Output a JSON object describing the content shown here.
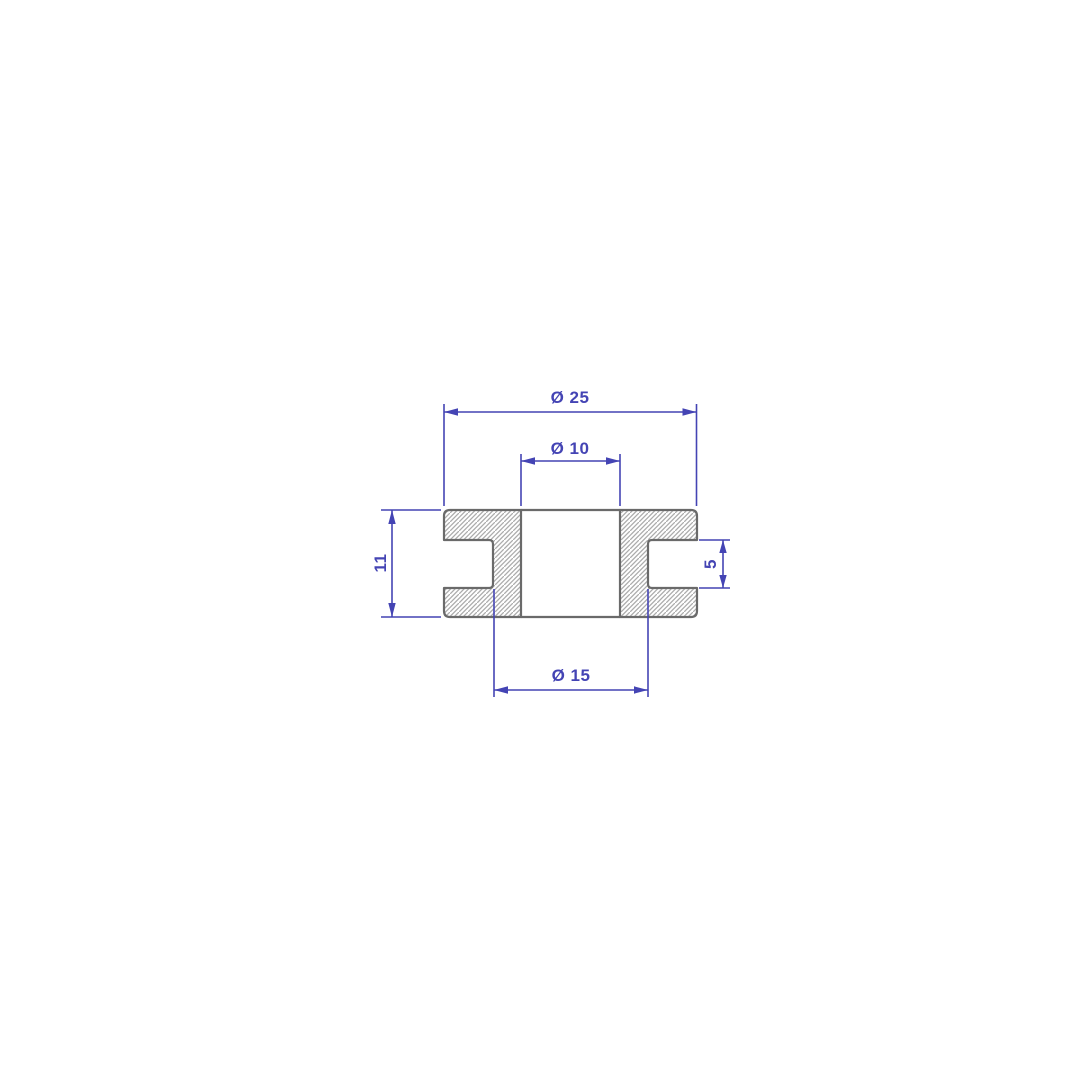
{
  "drawing": {
    "kind": "technical-section-drawing",
    "labels": {
      "outer_diameter": "Ø 25",
      "bore_diameter": "Ø 10",
      "groove_diameter": "Ø 15",
      "height": "11",
      "groove_width": "5"
    },
    "values": {
      "outer_diameter": 25,
      "bore_diameter": 10,
      "groove_diameter": 15,
      "height": 11,
      "groove_width": 5
    },
    "colors": {
      "dimension_blue": "#4444b4",
      "outline_gray": "#6a6a6a",
      "hatch_gray": "#acacac",
      "background": "#ffffff"
    }
  }
}
